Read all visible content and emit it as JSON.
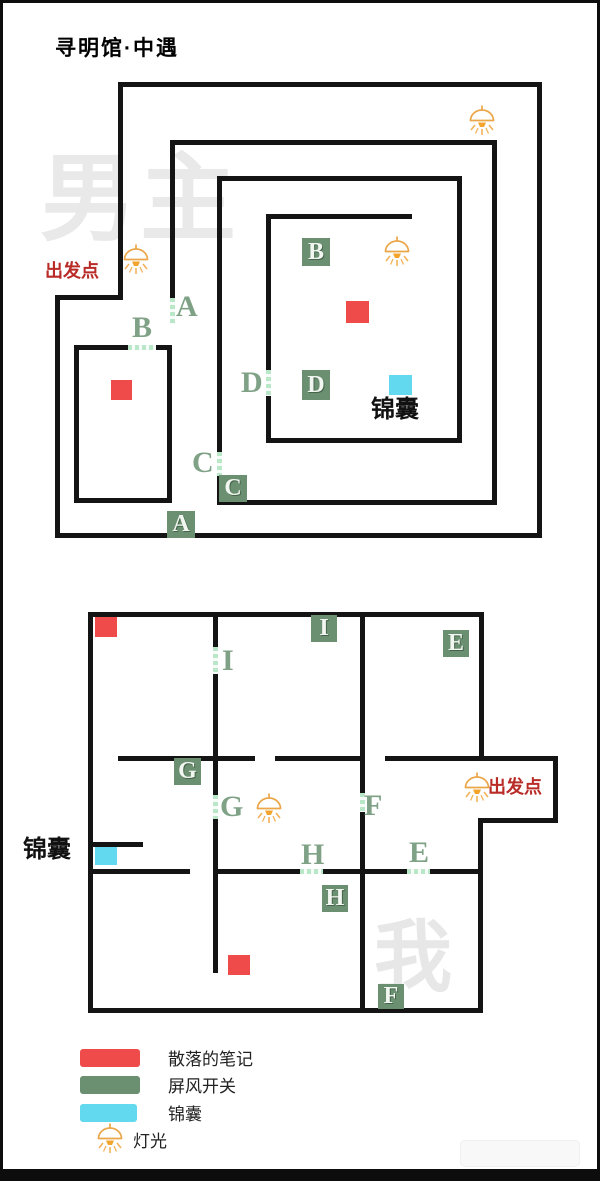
{
  "title": "寻明馆·中遇",
  "watermark_top": "男主",
  "watermark_bottom": "我",
  "maze1": {
    "start_label": "出发点",
    "pouch_label": "锦囊",
    "squares": {
      "b": "B",
      "d": "D",
      "c": "C",
      "a": "A"
    },
    "letters": {
      "a": "A",
      "b": "B",
      "c": "C",
      "d": "D"
    }
  },
  "maze2": {
    "start_label": "出发点",
    "pouch_label": "锦囊",
    "squares": {
      "i": "I",
      "e": "E",
      "g": "G",
      "h": "H",
      "f": "F"
    },
    "letters": {
      "i": "I",
      "g": "G",
      "f": "F",
      "h": "H",
      "e": "E"
    }
  },
  "legend": {
    "items": [
      {
        "label": "散落的笔记",
        "color": "#ef4b4b"
      },
      {
        "label": "屏风开关",
        "color": "#6b8f71"
      },
      {
        "label": "锦囊",
        "color": "#63d9ef"
      },
      {
        "label": "灯光",
        "color": "#eaa648"
      }
    ]
  },
  "colors": {
    "wall": "#141414",
    "door_dash": "#b9e7c8",
    "switch_green": "#6b8f71",
    "note_red": "#ef4b4b",
    "pouch_cyan": "#63d9ef",
    "lamp_orange": "#eaa648",
    "start_red": "#b92b26"
  }
}
